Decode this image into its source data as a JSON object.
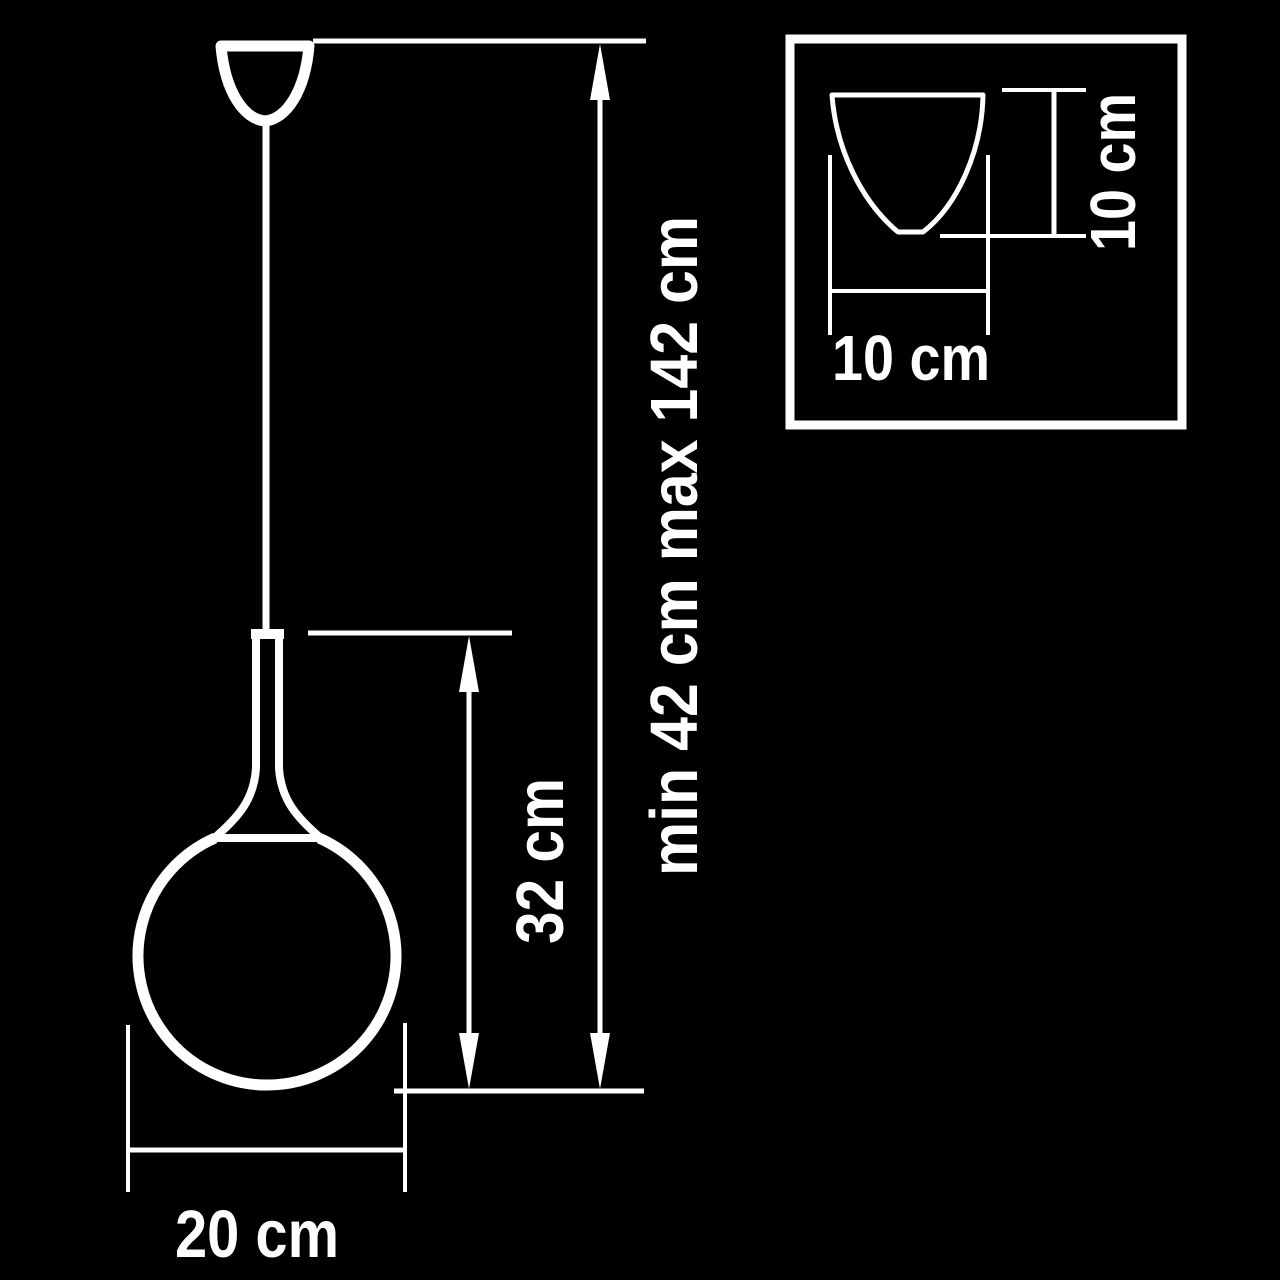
{
  "diagram": {
    "type": "pendant-lamp-dimension-drawing",
    "background_color": "#000000",
    "line_color": "#ffffff",
    "main_view": {
      "suspension_label": "min 42 cm max 142 cm",
      "shade_height_label": "32 cm",
      "globe_diameter_label": "20 cm"
    },
    "inset_view": {
      "width_label": "10 cm",
      "height_label": "10 cm"
    },
    "values": {
      "suspension_min_cm": 42,
      "suspension_max_cm": 142,
      "shade_height_cm": 32,
      "globe_diameter_cm": 20,
      "inset_width_cm": 10,
      "inset_height_cm": 10
    }
  }
}
